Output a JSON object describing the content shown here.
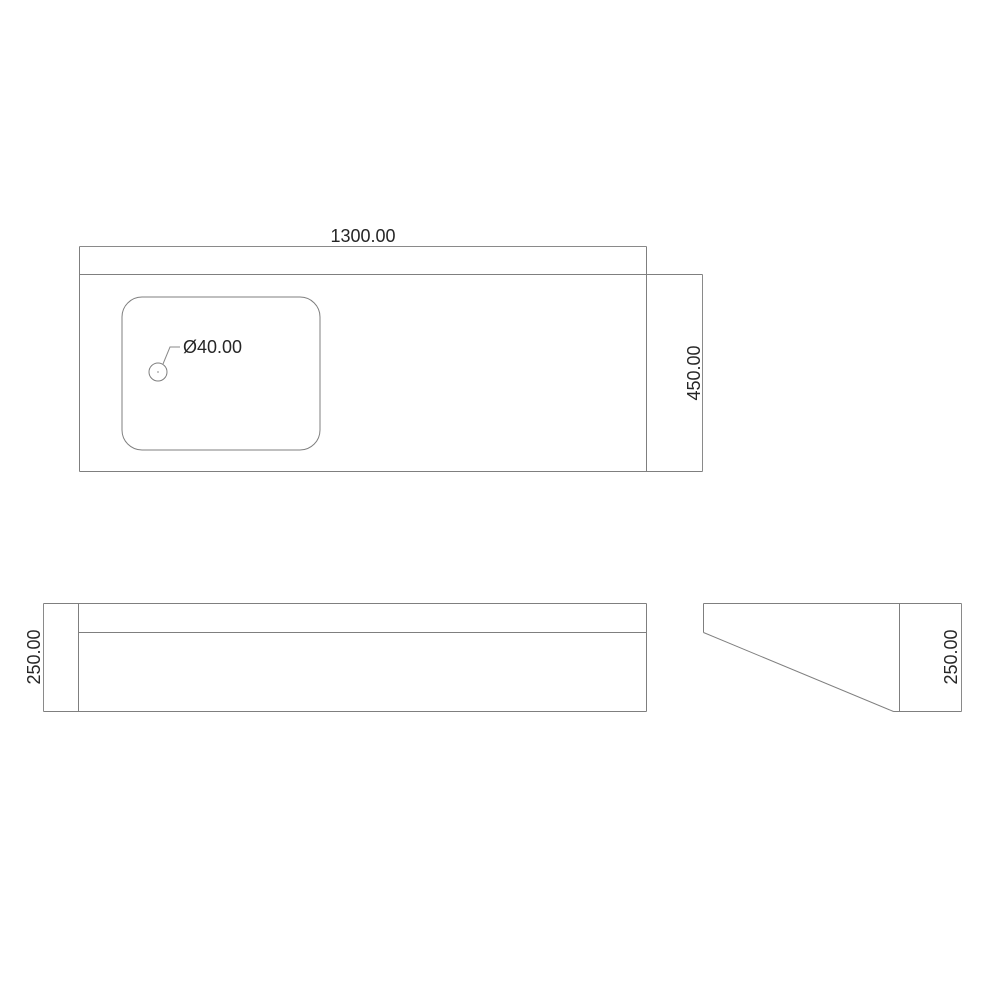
{
  "drawing": {
    "top_view": {
      "width_dim": "1300.00",
      "depth_dim": "450.00",
      "hole_dia_dim": "Ø40.00"
    },
    "front_view": {
      "height_dim": "250.00"
    },
    "side_view": {
      "height_dim": "250.00"
    },
    "colors": {
      "background": "#ffffff",
      "line": "#7f7f7f",
      "dim_line": "#8a8a8a",
      "dim_text": "#262626"
    }
  }
}
